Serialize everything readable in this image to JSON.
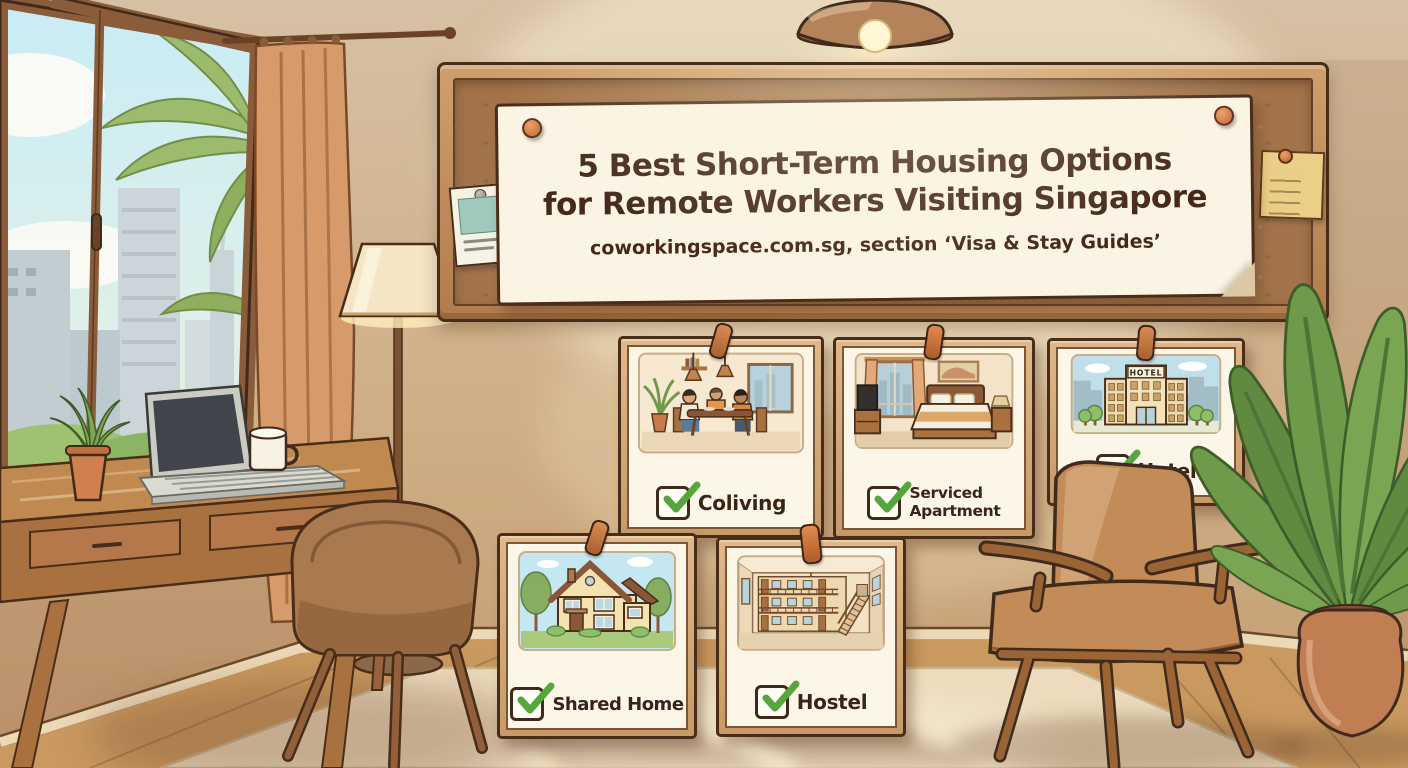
{
  "poster": {
    "title_line1": "5 Best Short-Term Housing Options",
    "title_line2": "for Remote Workers Visiting Singapore",
    "subtitle": "coworkingspace.com.sg, section ‘Visa & Stay Guides’"
  },
  "cards": {
    "coliving": {
      "label": "Coliving"
    },
    "serviced_apartment": {
      "label_line1": "Serviced",
      "label_line2": "Apartment"
    },
    "hotel": {
      "label": "Hotel",
      "building_sign": "HOTEL"
    },
    "shared_home": {
      "label": "Shared Home"
    },
    "hostel": {
      "label": "Hostel"
    }
  },
  "colors": {
    "check_green": "#55a63c",
    "text_brown": "#45281a",
    "poster_paper": "#fbf4e4",
    "cork_brown": "#a3744b",
    "frame_wood": "#c89a66",
    "wall_tan": "#d3b794",
    "accent_terracotta": "#c97a4d"
  }
}
